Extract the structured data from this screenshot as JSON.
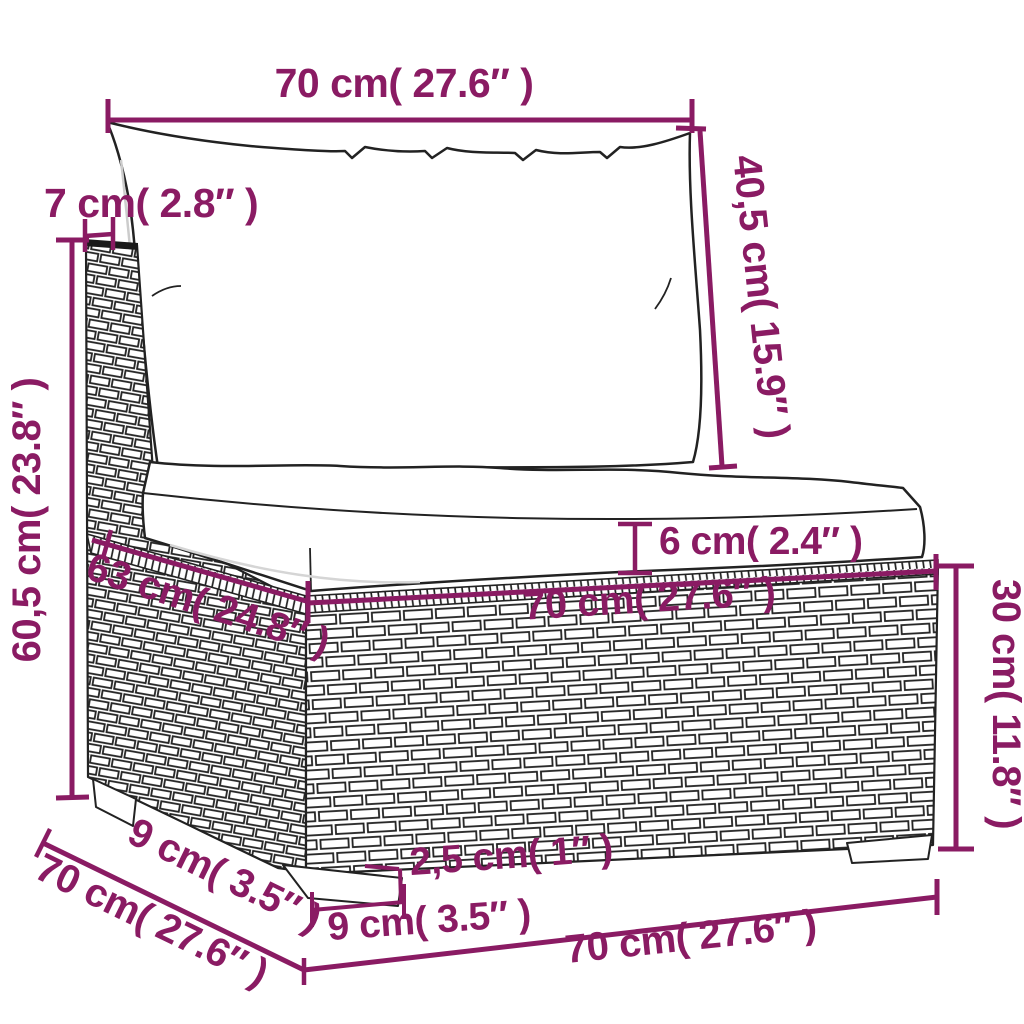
{
  "figure": {
    "type": "product-dimension-diagram",
    "subject": "rattan-garden-middle-sofa-with-cushions",
    "accent_color": "#8a1b63",
    "line_color": "#222222",
    "background": "#ffffff"
  },
  "dims": {
    "top_width": "70 cm( 27.6″ )",
    "post_width": "7 cm( 2.8″ )",
    "back_height": "40,5 cm( 15.9″ )",
    "total_height": "60,5 cm( 23.8″ )",
    "cushion_thickness": "6 cm( 2.4″ )",
    "seat_width": "70 cm( 27.6″ )",
    "seat_depth": "63 cm( 24.8″ )",
    "base_height": "30 cm( 11.8″ )",
    "side_leg_depth": "9 cm( 3.5″ )",
    "total_depth": "70 cm( 27.6″ )",
    "leg_height": "2,5 cm( 1″ )",
    "front_leg_width": "9 cm( 3.5″ )",
    "base_width": "70 cm( 27.6″ )"
  }
}
